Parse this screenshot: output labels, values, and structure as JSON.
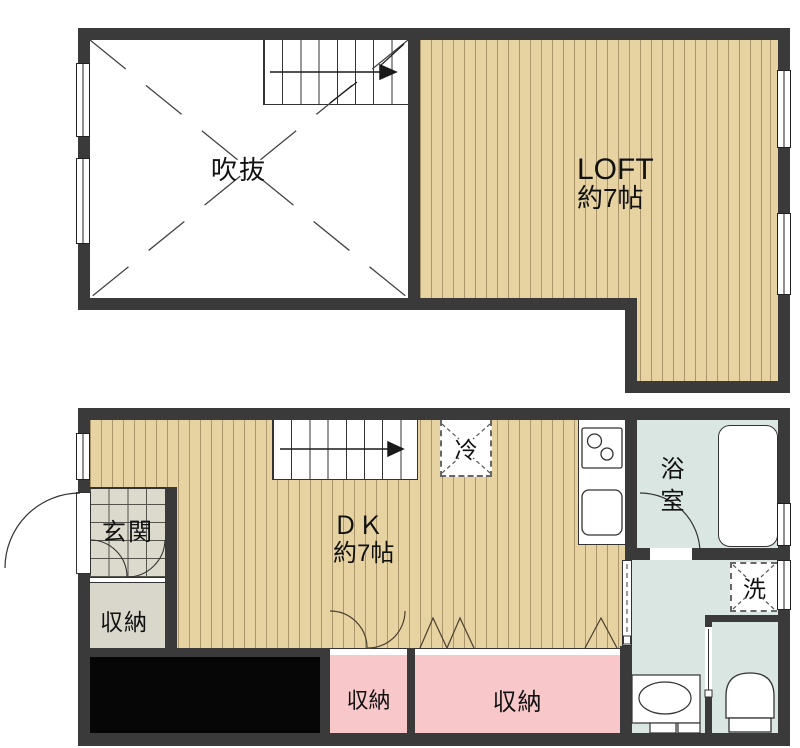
{
  "colors": {
    "wall": "#3a3a3a",
    "line": "#333333",
    "wood": "#e7d3a2",
    "wood_stripe": "rgba(122,100,62,0.55)",
    "water": "#d9e6e1",
    "pink": "#f8c7ca",
    "tile": "#dcd9cd",
    "tile_line": "#55544c",
    "gray_storage": "#d9d7cb",
    "black_area": "#060606",
    "text": "#111111"
  },
  "upper_floor": {
    "void_room": {
      "label": "吹抜"
    },
    "loft": {
      "name": "LOFT",
      "size": "約7帖"
    }
  },
  "lower_floor": {
    "dk": {
      "name": "ＤＫ",
      "size": "約7帖"
    },
    "entrance": {
      "label": "玄関"
    },
    "entrance_storage": {
      "label": "収納"
    },
    "bathroom": {
      "label": "浴室"
    },
    "refrigerator": {
      "label": "冷"
    },
    "washing_machine": {
      "label": "洗"
    },
    "storage_small": {
      "label": "収納"
    },
    "storage_large": {
      "label": "収納"
    }
  }
}
